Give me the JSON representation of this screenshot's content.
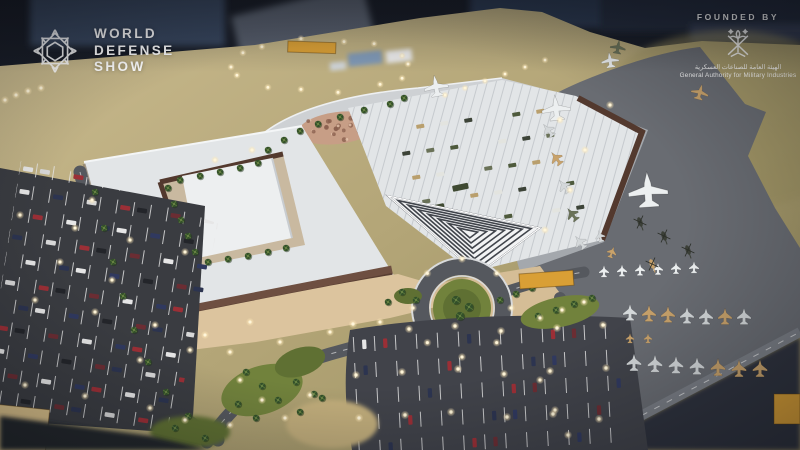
{
  "scene": {
    "description": "Aerial photograph of a physical scale model of the World Defense Show venue: exhibition halls, parking lots, aircraft static display apron and landscaped roads",
    "elements": {
      "exhibition_complex": "white exhibition halls with inner courtyard",
      "entrance_canopy": "chevron-striped entrance canopy",
      "aircraft_display": "rows of model fighter jets, transports and helicopters on grey apron",
      "parking": "car parks with miniature cars and lit lamp posts",
      "label_plaques": "blank gold plaques on model base"
    }
  },
  "branding": {
    "logo_lines": [
      "WORLD",
      "DEFENSE",
      "SHOW"
    ],
    "founded_by": {
      "label": "FOUNDED BY",
      "org_ar": "الهيئة العامة للصناعات العسكرية",
      "org_en": "General Authority for Military Industries"
    }
  },
  "colors": {
    "background": "#1d2330",
    "baseTop": "#c9ba8e",
    "baseMid": "#b3a577",
    "baseRight": "#9c9161",
    "apron": "#696c72",
    "apronLight": "#a4a8ad",
    "plaza": "#ced1d4",
    "asphalt": "#55585e",
    "lotAsphalt": "#3a3c41",
    "lotAsphalt2": "#41434a",
    "roofWhite": "#e2e5e7",
    "roofInner": "#edeff0",
    "ribLine": "#c6cace",
    "brick": "#6e4f41",
    "brickDark": "#53392e",
    "promenade": "#dcc49e",
    "plazaBeige": "#d5bd96",
    "lawn": "#71823c",
    "lawnDark": "#5f7033",
    "palm": "#33502a",
    "palmLight": "#57753a",
    "rockGarden": "#c79e86",
    "rockSpeckle": "#8a5f4d",
    "gold": "#d99f35",
    "goldPale": "#d9c089",
    "lightDot": "#fff6da",
    "white": "#ffffff",
    "jetSilver": "#d4d8da",
    "jetTan": "#c8a26b",
    "jetWhite": "#eceff0",
    "olive": "#6a7258",
    "heliDark": "#3c4038",
    "carColors": [
      "#e6e6e6",
      "#d8d8d8",
      "#30395f",
      "#9b2f36",
      "#23252a",
      "#e6e6e6",
      "#6b2d33",
      "#2c3450"
    ],
    "vehicleColors": [
      "#4e5a3c",
      "#b99f6d",
      "#e3e4df",
      "#3d4438",
      "#6a7258"
    ]
  }
}
